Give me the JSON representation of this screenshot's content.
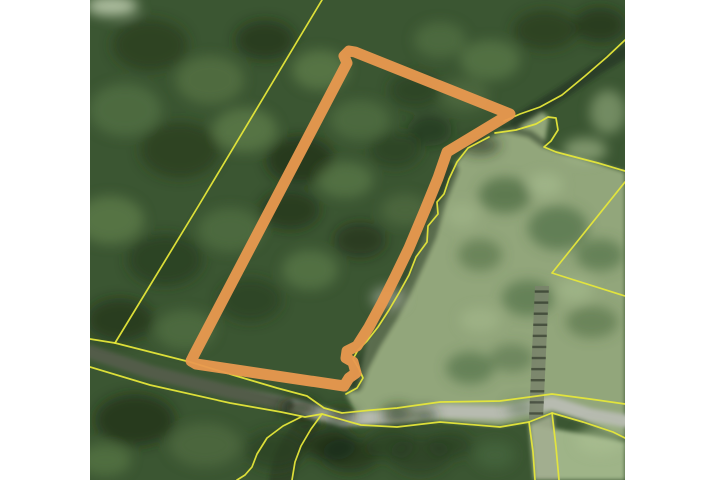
{
  "app": {
    "name": "parcel-map-viewer",
    "view": "aerial-imagery-with-parcel-overlay"
  },
  "canvas": {
    "width": 720,
    "height": 480,
    "map": {
      "x": 90,
      "y": 0,
      "width": 535,
      "height": 480
    },
    "margin_color": "#ffffff"
  },
  "palette": {
    "forest_base": "#3b5632",
    "forest_light1": "#5d7b4a",
    "forest_light2": "#6f9156",
    "forest_light3": "#87a468",
    "forest_dark1": "#263a1e",
    "forest_dark2": "#1b2b15",
    "canopy_pale": "#b9c9ab",
    "grass": "#97ab7e",
    "grass_light": "#aabf92",
    "tree_on_grass": "#4a6a40",
    "road_gray": "#b7bbb0",
    "road_dark": "#39452f",
    "stream_shadow": "#243421",
    "ladder_dark": "#3c4435",
    "ladder_light": "#79836b",
    "parcel_line_yellow": "#e6e73a",
    "parcel_highlight_orange": "#e9994f"
  },
  "map_features": {
    "highlight_parcel": {
      "kind": "selected-parcel-outline",
      "stroke": "parcel_highlight_orange",
      "stroke_width": 11,
      "opacity": 0.95,
      "d": "M 347,63 L 344,56 L 349,51 L 355,52 L 510,114 L 447,152 L 438,178 L 425,210 L 409,248 L 395,277 L 382,303 L 369,327 L 357,346 L 347,351 L 346,358 L 353,362 L 356,373 L 349,378 L 344,386 L 196,364 L 191,361 L 194,355 Z"
    },
    "regions": [
      {
        "name": "grass-east-region",
        "kind": "fill",
        "fill": "grass",
        "opacity": 0.95,
        "d": "M 489,137 L 520,125 L 540,111 L 549,117 L 544,147 L 560,153 L 600,164 L 625,172 L 625,438 L 583,421 L 552,412 L 529,421 L 500,426 L 440,421 L 361,424 L 346,394 L 358,388 L 367,341 L 389,310 L 409,275 L 428,226 L 444,194 L 457,162 L 468,148 Z"
      },
      {
        "name": "grass-southeast-region",
        "kind": "fill",
        "fill": "grass_light",
        "opacity": 0.9,
        "d": "M 529,424 L 625,442 L 625,480 L 534,480 Z"
      },
      {
        "name": "driveway-track",
        "kind": "fill",
        "fill": "#a3ad8f",
        "opacity": 0.9,
        "d": "M 530,423 L 553,414 L 559,480 L 535,480 Z"
      },
      {
        "name": "stream-corridor-shadow",
        "kind": "stroke",
        "stroke": "stream_shadow",
        "width": 13,
        "opacity": 0.7,
        "d": "M 625,52 L 598,68 L 566,90 L 538,108 L 516,122"
      },
      {
        "name": "stream-edge-shadow",
        "kind": "stroke",
        "stroke": "stream_shadow",
        "width": 14,
        "opacity": 0.5,
        "d": "M 452,170 L 440,200 L 430,235 L 418,262 L 404,292 L 390,318 L 374,344 L 362,367 L 356,385"
      },
      {
        "name": "stream-south-shadow",
        "kind": "stroke",
        "stroke": "stream_shadow",
        "width": 24,
        "opacity": 0.55,
        "d": "M 308,424 L 293,445 L 285,462 L 281,480"
      },
      {
        "name": "hook-shadow",
        "kind": "stroke",
        "stroke": "stream_shadow",
        "width": 8,
        "opacity": 0.5,
        "d": "M 505,128 L 530,134 L 544,144"
      },
      {
        "name": "road-surface",
        "kind": "stroke",
        "stroke": "road_gray",
        "width": 13,
        "opacity": 1,
        "d": "M 90,352 L 150,372 L 230,392 L 300,407 L 342,420 L 397,417 L 440,411 L 500,413 L 552,403 L 590,415 L 625,421"
      },
      {
        "name": "road-shaded-west",
        "kind": "stroke",
        "stroke": "road_dark",
        "width": 13,
        "opacity": 0.8,
        "d": "M 90,352 L 150,372 L 230,392 L 288,405"
      }
    ],
    "vegetation_blobs": [
      [
        112,
        6,
        26,
        10,
        "canopy_pale",
        0.9
      ],
      [
        150,
        45,
        38,
        26,
        "forest_dark1",
        0.7
      ],
      [
        210,
        80,
        34,
        24,
        "forest_light1",
        0.6
      ],
      [
        265,
        40,
        30,
        20,
        "forest_dark2",
        0.6
      ],
      [
        320,
        70,
        28,
        20,
        "forest_light2",
        0.5
      ],
      [
        125,
        110,
        36,
        26,
        "forest_light1",
        0.55
      ],
      [
        180,
        150,
        40,
        28,
        "forest_dark1",
        0.7
      ],
      [
        245,
        130,
        32,
        22,
        "forest_light2",
        0.5
      ],
      [
        300,
        160,
        34,
        24,
        "forest_dark2",
        0.65
      ],
      [
        360,
        120,
        30,
        20,
        "forest_light1",
        0.5
      ],
      [
        415,
        90,
        26,
        18,
        "forest_dark1",
        0.6
      ],
      [
        440,
        40,
        26,
        18,
        "forest_light1",
        0.5
      ],
      [
        490,
        60,
        30,
        20,
        "forest_light2",
        0.45
      ],
      [
        545,
        30,
        32,
        20,
        "forest_dark1",
        0.7
      ],
      [
        600,
        25,
        26,
        18,
        "forest_dark2",
        0.6
      ],
      [
        110,
        220,
        34,
        24,
        "forest_light2",
        0.5
      ],
      [
        165,
        260,
        38,
        26,
        "forest_dark1",
        0.65
      ],
      [
        230,
        230,
        32,
        22,
        "forest_light1",
        0.5
      ],
      [
        290,
        210,
        30,
        20,
        "forest_dark2",
        0.6
      ],
      [
        345,
        180,
        28,
        18,
        "forest_light2",
        0.45
      ],
      [
        395,
        150,
        26,
        18,
        "forest_dark1",
        0.6
      ],
      [
        430,
        130,
        22,
        16,
        "forest_dark2",
        0.5
      ],
      [
        465,
        95,
        24,
        16,
        "forest_light1",
        0.45
      ],
      [
        120,
        320,
        34,
        22,
        "forest_dark2",
        0.6
      ],
      [
        185,
        330,
        30,
        20,
        "forest_light1",
        0.5
      ],
      [
        250,
        300,
        32,
        22,
        "forest_dark1",
        0.6
      ],
      [
        310,
        270,
        28,
        20,
        "forest_light2",
        0.45
      ],
      [
        360,
        240,
        26,
        18,
        "forest_dark2",
        0.55
      ],
      [
        405,
        210,
        24,
        16,
        "forest_light1",
        0.45
      ],
      [
        388,
        298,
        17,
        11,
        "road_gray",
        0.55
      ],
      [
        135,
        420,
        40,
        26,
        "forest_dark2",
        0.65
      ],
      [
        205,
        445,
        36,
        22,
        "forest_light1",
        0.45
      ],
      [
        275,
        450,
        30,
        20,
        "forest_dark1",
        0.6
      ],
      [
        350,
        455,
        28,
        18,
        "forest_dark2",
        0.6
      ],
      [
        420,
        455,
        30,
        20,
        "forest_dark1",
        0.55
      ],
      [
        105,
        460,
        26,
        16,
        "forest_light2",
        0.4
      ],
      [
        330,
        445,
        26,
        16,
        "forest_dark2",
        0.7
      ],
      [
        390,
        445,
        24,
        16,
        "forest_dark1",
        0.6
      ],
      [
        450,
        445,
        22,
        14,
        "forest_dark1",
        0.6
      ],
      [
        495,
        455,
        20,
        14,
        "tree_on_grass",
        0.6
      ],
      [
        505,
        195,
        26,
        18,
        "tree_on_grass",
        0.7
      ],
      [
        558,
        228,
        30,
        22,
        "tree_on_grass",
        0.65
      ],
      [
        600,
        255,
        24,
        16,
        "tree_on_grass",
        0.6
      ],
      [
        528,
        298,
        26,
        18,
        "tree_on_grass",
        0.6
      ],
      [
        480,
        255,
        22,
        16,
        "tree_on_grass",
        0.55
      ],
      [
        592,
        322,
        26,
        16,
        "tree_on_grass",
        0.55
      ],
      [
        470,
        368,
        24,
        16,
        "tree_on_grass",
        0.6
      ],
      [
        512,
        358,
        22,
        14,
        "tree_on_grass",
        0.5
      ],
      [
        585,
        150,
        22,
        12,
        "grass_light",
        0.6
      ],
      [
        608,
        112,
        18,
        22,
        "grass_light",
        0.5
      ],
      [
        545,
        185,
        18,
        12,
        "grass_light",
        0.55
      ],
      [
        575,
        290,
        18,
        12,
        "grass_light",
        0.5
      ],
      [
        600,
        440,
        24,
        14,
        "grass_light",
        0.6
      ],
      [
        480,
        320,
        20,
        12,
        "grass_light",
        0.45
      ],
      [
        462,
        215,
        16,
        12,
        "grass_light",
        0.4
      ],
      [
        480,
        145,
        20,
        10,
        "stream_shadow",
        0.6
      ],
      [
        300,
        408,
        20,
        10,
        "forest_dark2",
        0.7
      ],
      [
        340,
        416,
        16,
        9,
        "forest_dark2",
        0.6
      ],
      [
        398,
        414,
        16,
        9,
        "forest_dark1",
        0.7
      ],
      [
        425,
        416,
        12,
        8,
        "forest_dark1",
        0.6
      ],
      [
        520,
        408,
        14,
        8,
        "tree_on_grass",
        0.5
      ]
    ],
    "ladder": {
      "top": [
        535,
        286,
        549,
        286
      ],
      "bottom": [
        529,
        419,
        543,
        419
      ],
      "rail_fill": "ladder_light",
      "rung_stroke": "ladder_dark",
      "rungs": 12,
      "opacity": 0.85
    },
    "boundary_lines": {
      "stroke": "parcel_line_yellow",
      "width": 1.7,
      "opacity": 0.95,
      "lines": [
        {
          "id": "west-diagonal-line",
          "d": "M 322,0 L 199,205 L 115,343 L 90,339"
        },
        {
          "id": "road-north-line",
          "d": "M 115,343 L 190,362 L 233,375 L 277,388 L 307,396 L 324,408 L 342,413 L 372,410 L 397,408 L 440,402 L 500,401 L 552,394 L 590,399 L 625,404"
        },
        {
          "id": "road-south-line",
          "d": "M 90,367 L 150,385 L 230,403 L 281,412 L 305,417 L 322,414 L 361,425 L 397,427 L 440,422 L 500,427 L 529,422 L 552,413 L 583,422 L 613,432 L 625,438"
        },
        {
          "id": "driveway-west-line",
          "d": "M 529,422 L 533,452 L 535,480"
        },
        {
          "id": "driveway-east-line",
          "d": "M 552,413 L 556,447 L 559,480"
        },
        {
          "id": "stream-west-line",
          "d": "M 301,417 L 283,426 L 267,438 L 257,454 L 252,467 L 245,475 L 237,480"
        },
        {
          "id": "stream-east-line",
          "d": "M 322,414 L 311,429 L 301,446 L 295,462 L 292,480"
        },
        {
          "id": "stream-corridor-north-line",
          "d": "M 625,40 L 607,57 L 585,76 L 562,95 L 540,107 L 520,114 L 504,121"
        },
        {
          "id": "stream-corridor-south-line",
          "d": "M 495,133 L 516,130 L 536,124 L 548,117 L 556,118 L 558,130 L 551,141 L 544,147 L 556,152 L 575,157 L 598,163 L 625,171"
        },
        {
          "id": "east-parcel-wedge-line",
          "d": "M 625,182 L 552,273 L 625,296"
        },
        {
          "id": "stream-west-bank-line",
          "d": "M 489,137 L 468,148 L 457,162 L 449,179 L 444,194 L 437,202 L 438,214 L 428,226 L 427,242 L 416,257 L 409,275 L 399,293 L 389,310 L 378,327 L 367,341 L 358,350 L 353,359 L 359,369 L 363,378 L 357,388 L 346,394"
        }
      ]
    }
  }
}
